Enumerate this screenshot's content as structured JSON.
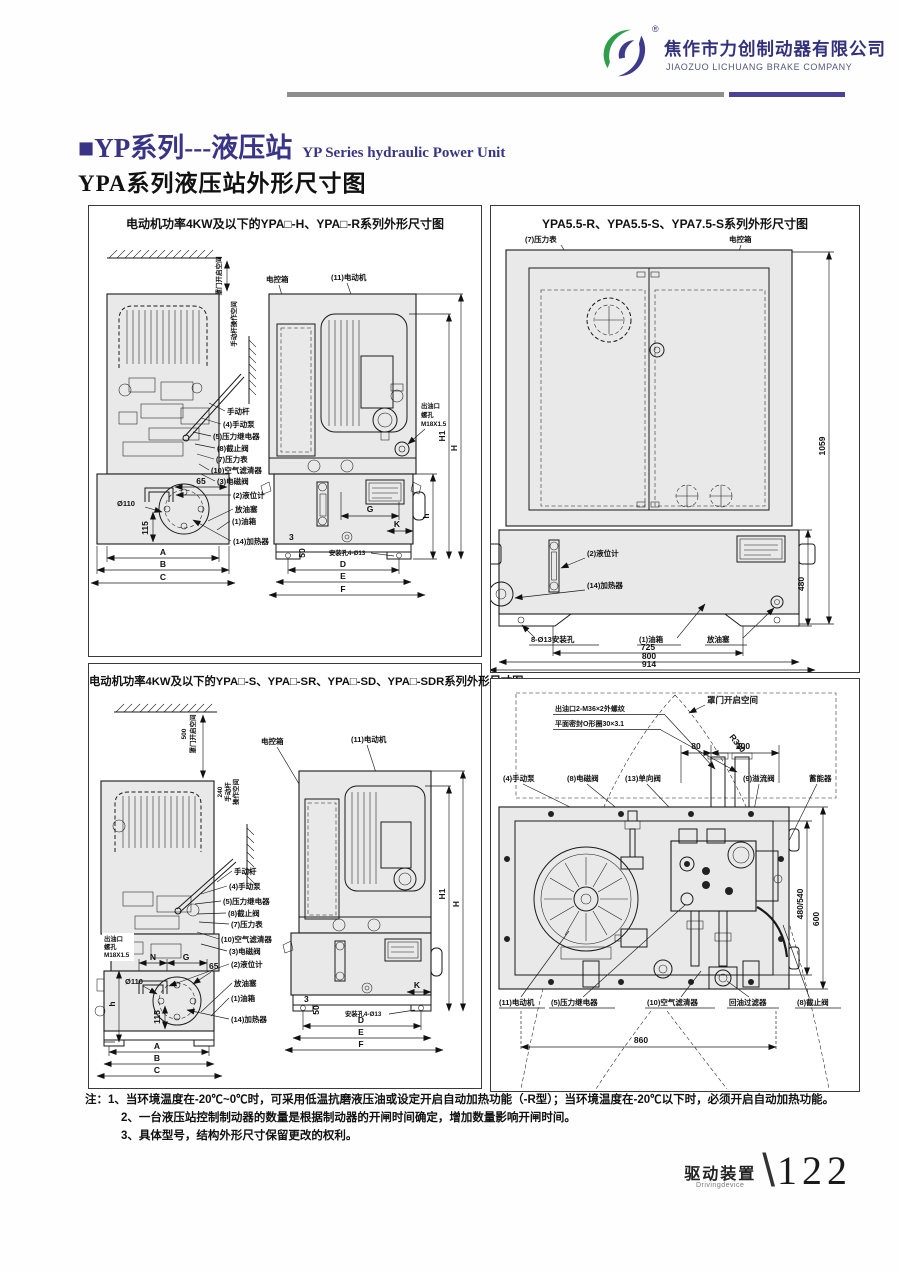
{
  "header": {
    "company_cn": "焦作市力创制动器有限公司",
    "company_en": "JIAOZUO LICHUANG BRAKE COMPANY",
    "registered_mark": "®"
  },
  "title": {
    "cn": "■YP系列---液压站",
    "en": "YP Series hydraulic Power Unit",
    "subtitle": "YPA系列液压站外形尺寸图"
  },
  "panel1": {
    "title": "电动机功率4KW及以下的YPA□-H、YPA□-R系列外形尺寸图",
    "labels": {
      "hood_space": "罩门开启空间",
      "lever_space": "手动杆操作空间",
      "control_box": "电控箱",
      "motor": "(11)电动机",
      "hand_lever": "手动杆",
      "hand_pump": "(4)手动泵",
      "pressure_relay": "(5)压力继电器",
      "stop_valve": "(8)截止阀",
      "pressure_gauge": "(7)压力表",
      "air_filter": "(10)空气滤清器",
      "solenoid_valve": "(3)电磁阀",
      "level_gauge": "(2)液位计",
      "drain_plug": "放油塞",
      "oil_tank": "(1)油箱",
      "heater": "(14)加热器",
      "outlet_l1": "出油口",
      "outlet_l2": "螺孔",
      "outlet_l3": "M18X1.5",
      "mount_holes": "安装孔4-Ø13"
    },
    "dims": {
      "dia110": "Ø110",
      "n65": "65",
      "n115": "115",
      "A": "A",
      "B": "B",
      "C": "C",
      "G": "G",
      "K": "K",
      "n3": "3",
      "n50": "50",
      "D": "D",
      "E": "E",
      "F": "F",
      "h": "h",
      "H1": "H1",
      "H": "H"
    }
  },
  "panel2": {
    "title": "YPA5.5-R、YPA5.5-S、YPA7.5-S系列外形尺寸图",
    "labels": {
      "pressure_gauge": "(7)压力表",
      "control_box": "电控箱",
      "level_gauge": "(2)液位计",
      "heater": "(14)加热器",
      "mount_holes": "8-Ø13安装孔",
      "oil_tank": "(1)油箱",
      "drain_plug": "放油塞"
    },
    "dims": {
      "v1059": "1059",
      "v480": "480",
      "w725": "725",
      "w800": "800",
      "w914": "914"
    }
  },
  "panel3": {
    "title": "电动机功率4KW及以下的YPA□-S、YPA□-SR、YPA□-SD、YPA□-SDR系列外形尺寸图",
    "labels": {
      "hood_space_value": "500",
      "hood_space": "罩门开启空间",
      "lever_value": "240",
      "lever_l1": "手动杆",
      "lever_l2": "操作空间",
      "control_box": "电控箱",
      "motor": "(11)电动机",
      "hand_lever": "手动杆",
      "hand_pump": "(4)手动泵",
      "pressure_relay": "(5)压力继电器",
      "stop_valve": "(8)截止阀",
      "pressure_gauge": "(7)压力表",
      "air_filter": "(10)空气滤清器",
      "solenoid_valve": "(3)电磁阀",
      "level_gauge": "(2)液位计",
      "drain_plug": "放油塞",
      "oil_tank": "(1)油箱",
      "heater": "(14)加热器",
      "outlet_l1": "出油口",
      "outlet_l2": "螺孔",
      "outlet_l3": "M18X1.5",
      "mount_holes": "安装孔4-Ø13"
    },
    "dims": {
      "dia110": "Ø110",
      "n65": "65",
      "n115": "115",
      "N": "N",
      "G": "G",
      "A": "A",
      "B": "B",
      "C": "C",
      "h": "h",
      "K": "K",
      "n3": "3",
      "n50": "50",
      "D": "D",
      "E": "E",
      "F": "F",
      "H1": "H1",
      "H": "H"
    }
  },
  "panel4": {
    "labels": {
      "hood_space": "罩门开启空间",
      "radius": "R390",
      "outlet_l1": "出油口2-M36×2外螺纹",
      "outlet_l2": "平面密封O形圈30×3.1",
      "hand_pump": "(4)手动泵",
      "solenoid_valve": "(8)电磁阀",
      "check_valve": "(13)单向阀",
      "relief_valve": "(9)溢流阀",
      "accumulator": "蓄能器",
      "motor": "(11)电动机",
      "pressure_relay": "(5)压力继电器",
      "air_filter": "(10)空气滤清器",
      "return_filter": "回油过滤器",
      "stop_valve": "(8)截止阀"
    },
    "dims": {
      "n80": "80",
      "n200": "200",
      "n860": "860",
      "v480540": "480/540",
      "v600": "600"
    }
  },
  "notes": {
    "prefix": "注：",
    "items": [
      "1、当环境温度在-20℃~0℃时，可采用低温抗磨液压油或设定开启自动加热功能（-R型）；当环境温度在-20℃以下时，必须开启自动加热功能。",
      "2、一台液压站控制制动器的数量是根据制动器的开闸时间确定，增加数量影响开闸时间。",
      "3、具体型号，结构外形尺寸保留更改的权利。"
    ]
  },
  "footer": {
    "section_cn": "驱动装置",
    "section_en": "Drivingdevice",
    "separator": "\\",
    "page": "122"
  }
}
